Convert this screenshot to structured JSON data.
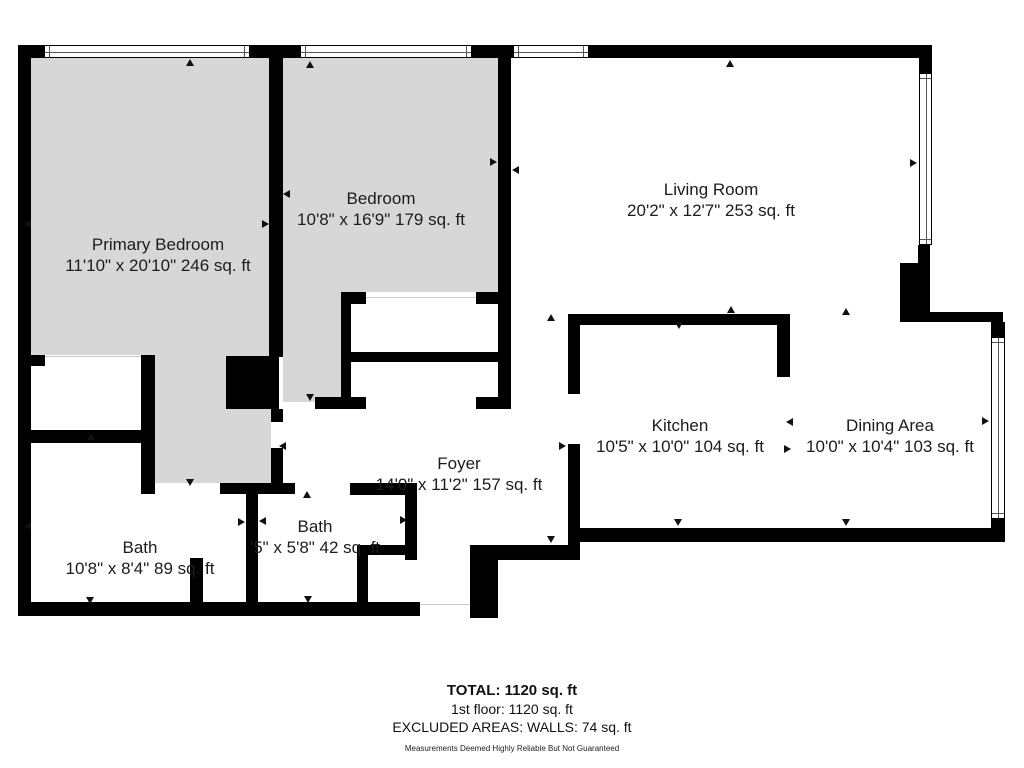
{
  "floor_plan": {
    "colors": {
      "wall": "#000000",
      "floor_gray": "#d7d7d7",
      "background": "#ffffff",
      "opening_line": "#c9c9c9"
    },
    "rooms": [
      {
        "name": "primary-bedroom",
        "label": "Primary Bedroom",
        "dims": "11'10\" x 20'10\" 246 sq. ft",
        "cx": 158,
        "cy": 255
      },
      {
        "name": "bedroom",
        "label": "Bedroom",
        "dims": "10'8\" x 16'9\" 179 sq. ft",
        "cx": 381,
        "cy": 209
      },
      {
        "name": "living-room",
        "label": "Living Room",
        "dims": "20'2\" x 12'7\" 253 sq. ft",
        "cx": 711,
        "cy": 200
      },
      {
        "name": "kitchen",
        "label": "Kitchen",
        "dims": "10'5\" x 10'0\" 104 sq. ft",
        "cx": 680,
        "cy": 436
      },
      {
        "name": "dining-area",
        "label": "Dining Area",
        "dims": "10'0\" x 10'4\" 103 sq. ft",
        "cx": 890,
        "cy": 436
      },
      {
        "name": "foyer",
        "label": "Foyer",
        "dims": "14'0\" x 11'2\" 157 sq. ft",
        "cx": 459,
        "cy": 474
      },
      {
        "name": "bath-primary",
        "label": "Bath",
        "dims": "10'8\" x 8'4\" 89 sq. ft",
        "cx": 140,
        "cy": 558
      },
      {
        "name": "bath-2",
        "label": "Bath",
        "dims": "'5\" x 5'8\" 42 sq. ft",
        "cx": 315,
        "cy": 537
      }
    ],
    "floors": [
      [
        31,
        58,
        238,
        297
      ],
      [
        155,
        355,
        116,
        128
      ],
      [
        283,
        58,
        215,
        234
      ],
      [
        283,
        292,
        58,
        110
      ]
    ],
    "walls": [
      [
        18,
        45,
        26,
        13
      ],
      [
        250,
        45,
        50,
        13
      ],
      [
        472,
        45,
        41,
        13
      ],
      [
        589,
        45,
        343,
        13
      ],
      [
        18,
        45,
        13,
        571
      ],
      [
        18,
        602,
        402,
        14
      ],
      [
        470,
        545,
        28,
        73
      ],
      [
        498,
        545,
        82,
        15
      ],
      [
        568,
        528,
        12,
        30
      ],
      [
        577,
        528,
        426,
        14
      ],
      [
        991,
        322,
        14,
        16
      ],
      [
        991,
        519,
        14,
        23
      ],
      [
        930,
        312,
        73,
        10
      ],
      [
        900,
        263,
        30,
        59
      ],
      [
        918,
        245,
        12,
        18
      ],
      [
        919,
        45,
        13,
        29
      ],
      [
        269,
        57,
        14,
        300
      ],
      [
        226,
        356,
        53,
        53
      ],
      [
        271,
        409,
        12,
        13
      ],
      [
        271,
        448,
        12,
        46
      ],
      [
        31,
        355,
        14,
        11
      ],
      [
        141,
        355,
        14,
        139
      ],
      [
        18,
        430,
        135,
        13
      ],
      [
        220,
        483,
        75,
        11
      ],
      [
        350,
        483,
        65,
        12
      ],
      [
        246,
        488,
        12,
        126
      ],
      [
        190,
        558,
        13,
        57
      ],
      [
        405,
        483,
        12,
        77
      ],
      [
        357,
        545,
        58,
        10
      ],
      [
        357,
        545,
        11,
        71
      ],
      [
        341,
        292,
        25,
        12
      ],
      [
        476,
        292,
        26,
        12
      ],
      [
        341,
        292,
        10,
        117
      ],
      [
        341,
        352,
        170,
        10
      ],
      [
        315,
        397,
        51,
        12
      ],
      [
        476,
        397,
        26,
        12
      ],
      [
        498,
        57,
        13,
        352
      ],
      [
        568,
        314,
        222,
        11
      ],
      [
        777,
        325,
        13,
        52
      ],
      [
        568,
        314,
        12,
        80
      ],
      [
        568,
        444,
        12,
        96
      ]
    ],
    "windows": [
      {
        "r": [
          44,
          45,
          206,
          13
        ],
        "o": "h"
      },
      {
        "r": [
          300,
          45,
          172,
          13
        ],
        "o": "h"
      },
      {
        "r": [
          513,
          45,
          76,
          13
        ],
        "o": "h"
      },
      {
        "r": [
          919,
          73,
          13,
          172
        ],
        "o": "v"
      },
      {
        "r": [
          991,
          337,
          14,
          182
        ],
        "o": "v"
      }
    ],
    "opening_lines": [
      [
        45,
        356,
        97,
        1
      ],
      [
        366,
        297,
        110,
        1
      ],
      [
        420,
        604,
        50,
        1
      ]
    ],
    "arrows": [
      {
        "x": 190,
        "y": 59,
        "d": "up"
      },
      {
        "x": 310,
        "y": 61,
        "d": "up"
      },
      {
        "x": 730,
        "y": 60,
        "d": "up"
      },
      {
        "x": 24,
        "y": 224,
        "d": "left"
      },
      {
        "x": 24,
        "y": 526,
        "d": "left"
      },
      {
        "x": 917,
        "y": 163,
        "d": "right"
      },
      {
        "x": 989,
        "y": 421,
        "d": "right"
      },
      {
        "x": 283,
        "y": 194,
        "d": "left"
      },
      {
        "x": 269,
        "y": 224,
        "d": "right"
      },
      {
        "x": 497,
        "y": 162,
        "d": "right"
      },
      {
        "x": 512,
        "y": 170,
        "d": "left"
      },
      {
        "x": 245,
        "y": 522,
        "d": "right"
      },
      {
        "x": 259,
        "y": 521,
        "d": "left"
      },
      {
        "x": 551,
        "y": 314,
        "d": "up"
      },
      {
        "x": 679,
        "y": 329,
        "d": "down"
      },
      {
        "x": 731,
        "y": 306,
        "d": "up"
      },
      {
        "x": 846,
        "y": 308,
        "d": "up"
      },
      {
        "x": 786,
        "y": 422,
        "d": "left"
      },
      {
        "x": 791,
        "y": 449,
        "d": "right"
      },
      {
        "x": 310,
        "y": 401,
        "d": "down"
      },
      {
        "x": 279,
        "y": 446,
        "d": "left"
      },
      {
        "x": 307,
        "y": 491,
        "d": "up"
      },
      {
        "x": 407,
        "y": 520,
        "d": "right"
      },
      {
        "x": 91,
        "y": 433,
        "d": "up"
      },
      {
        "x": 190,
        "y": 486,
        "d": "down"
      },
      {
        "x": 90,
        "y": 604,
        "d": "down"
      },
      {
        "x": 308,
        "y": 603,
        "d": "down"
      },
      {
        "x": 551,
        "y": 543,
        "d": "down"
      },
      {
        "x": 678,
        "y": 526,
        "d": "down"
      },
      {
        "x": 846,
        "y": 526,
        "d": "down"
      },
      {
        "x": 566,
        "y": 446,
        "d": "right"
      }
    ],
    "footer": {
      "total": "TOTAL: 1120 sq. ft",
      "floor1": "1st floor: 1120 sq. ft",
      "excluded": "EXCLUDED AREAS: WALLS: 74 sq. ft",
      "disclaimer": "Measurements Deemed Highly Reliable But Not Guaranteed"
    }
  }
}
